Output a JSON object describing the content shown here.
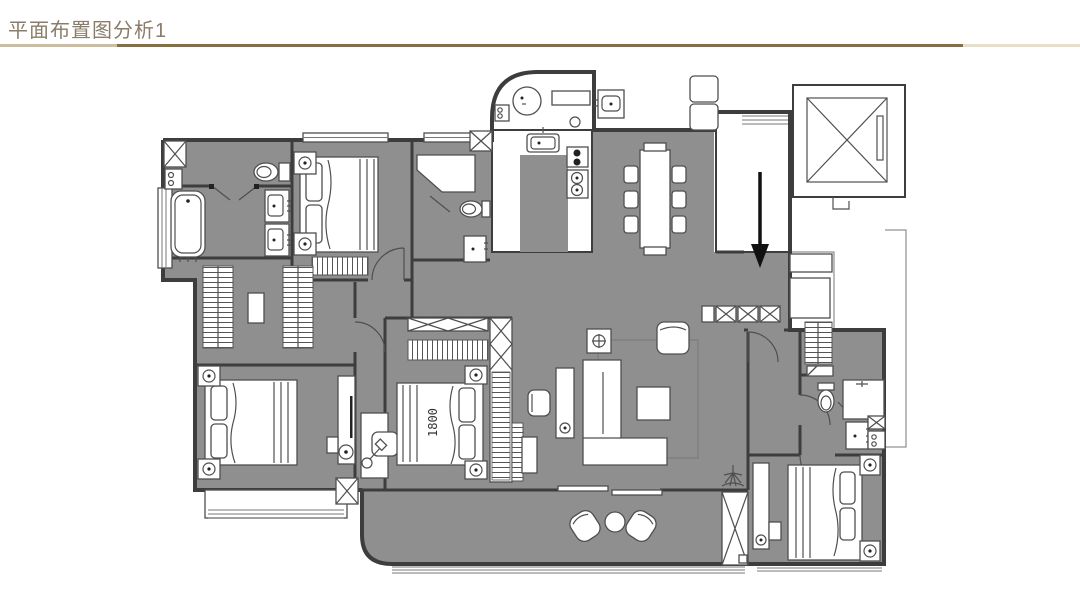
{
  "header": {
    "title": "平面布置图分析1"
  },
  "plan": {
    "bed_width_label": "1800",
    "annotation": "black entry arrow pointing down into the unit",
    "furniture_icons": [
      "double-bed",
      "nightstand-lamp",
      "wardrobe-hanger-rail",
      "bathtub",
      "toilet",
      "vanity-sink",
      "shower-stall",
      "dining-table",
      "dining-chair",
      "l-shaped-sofa",
      "area-rug",
      "coffee-table",
      "armchair",
      "side-table",
      "tv-cabinet",
      "kitchen-sink",
      "cooktop",
      "washing-machine",
      "elevator",
      "shoe-cabinet",
      "entry-door",
      "lounge-chair",
      "round-table",
      "potted-plant",
      "desk-chair",
      "floor-lamp",
      "structural-column",
      "down-arrow"
    ]
  },
  "colors": {
    "title_text": "#8a7c68",
    "divider_light": "#cdbd9d",
    "divider_dark": "#8a6d3e",
    "divider_light2": "#e9dfc6",
    "floor_fill": "#8f8f8f",
    "wall_stroke": "#3d3d3d",
    "line_color": "#4f4f4f",
    "arrow_color": "#111111",
    "background": "#ffffff"
  }
}
